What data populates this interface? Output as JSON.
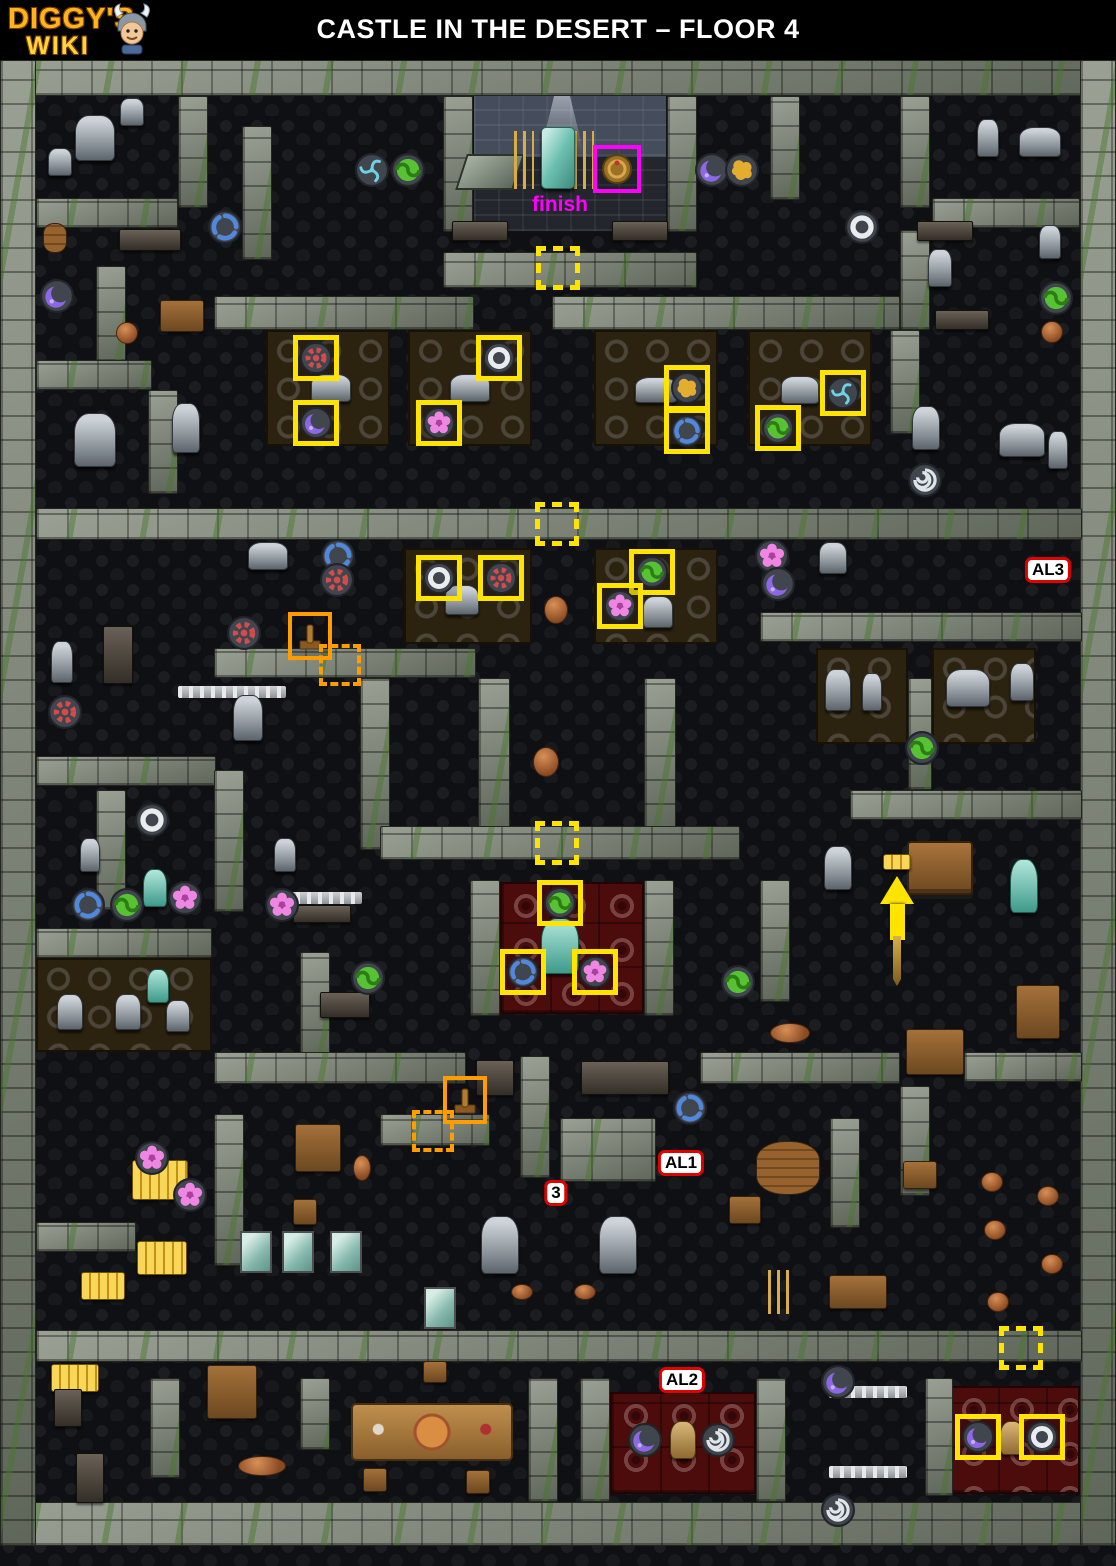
{
  "header": {
    "logo_line1": "DIGGY'S",
    "logo_line2": "WIKI",
    "title": "CASTLE IN THE DESERT – FLOOR 4"
  },
  "colors": {
    "highlight_yellow": "#ffe400",
    "highlight_orange": "#ff9d00",
    "finish_magenta": "#ff00ff",
    "label_border_red": "#e00000",
    "logo_orange": "#ffb41e",
    "wall_gray": "#7b8178",
    "moss_green": "#48762c",
    "carpet_red": "#4c0c0c",
    "floor_dark": "#0f1013"
  },
  "map": {
    "finish": {
      "label": "finish",
      "x": 560,
      "y": 205,
      "box_x": 617,
      "box_y": 169
    },
    "labels": [
      {
        "text": "AL3",
        "x": 1048,
        "y": 570
      },
      {
        "text": "AL1",
        "x": 681,
        "y": 1163
      },
      {
        "text": "3",
        "x": 556,
        "y": 1193
      },
      {
        "text": "AL2",
        "x": 682,
        "y": 1380
      }
    ],
    "yellow_boxes": [
      [
        "red-gear",
        316,
        358
      ],
      [
        "purple-crescent",
        316,
        423
      ],
      [
        "white-ring",
        499,
        358
      ],
      [
        "pink-flower",
        439,
        423
      ],
      [
        "gold-splat",
        687,
        388
      ],
      [
        "blue-swirl",
        687,
        431
      ],
      [
        "cyan-triskelion",
        843,
        393
      ],
      [
        "green-swirl",
        778,
        428
      ],
      [
        "white-ring",
        439,
        578
      ],
      [
        "red-gear",
        501,
        578
      ],
      [
        "green-swirl",
        652,
        572
      ],
      [
        "pink-flower",
        620,
        606
      ],
      [
        "green-swirl",
        560,
        903
      ],
      [
        "blue-swirl",
        523,
        972
      ],
      [
        "pink-flower",
        595,
        972
      ],
      [
        "purple-crescent",
        978,
        1437
      ],
      [
        "white-ring",
        1042,
        1437
      ]
    ],
    "hidden_passages": [
      [
        558,
        268
      ],
      [
        557,
        524
      ],
      [
        557,
        843
      ],
      [
        1021,
        1348
      ]
    ],
    "lever_boxes": [
      [
        310,
        636
      ],
      [
        465,
        1100
      ]
    ],
    "lever_targets": [
      [
        340,
        665
      ],
      [
        433,
        1131
      ]
    ],
    "arrow": {
      "x": 897,
      "y": 876
    },
    "loose_symbols": [
      [
        "cyan-triskelion",
        372,
        170
      ],
      [
        "green-swirl",
        408,
        170
      ],
      [
        "purple-crescent",
        712,
        170
      ],
      [
        "gold-splat",
        742,
        170
      ],
      [
        "blue-swirl",
        225,
        227
      ],
      [
        "white-ring",
        862,
        227
      ],
      [
        "purple-crescent",
        57,
        296
      ],
      [
        "green-swirl",
        1056,
        298
      ],
      [
        "white-spiral",
        925,
        480
      ],
      [
        "blue-swirl",
        338,
        556
      ],
      [
        "red-gear",
        337,
        580
      ],
      [
        "pink-flower",
        772,
        556
      ],
      [
        "purple-crescent",
        778,
        584
      ],
      [
        "red-gear",
        244,
        633
      ],
      [
        "red-gear",
        65,
        712
      ],
      [
        "green-swirl",
        922,
        748
      ],
      [
        "white-ring",
        152,
        820
      ],
      [
        "blue-swirl",
        88,
        905
      ],
      [
        "green-swirl",
        127,
        905
      ],
      [
        "pink-flower",
        185,
        898
      ],
      [
        "pink-flower",
        282,
        905
      ],
      [
        "green-swirl",
        368,
        978
      ],
      [
        "green-swirl",
        738,
        982
      ],
      [
        "blue-swirl",
        690,
        1108
      ],
      [
        "pink-flower",
        152,
        1158
      ],
      [
        "pink-flower",
        190,
        1195
      ],
      [
        "purple-crescent",
        838,
        1382
      ],
      [
        "white-spiral",
        838,
        1510
      ],
      [
        "purple-crescent",
        645,
        1440
      ],
      [
        "white-spiral",
        718,
        1440
      ]
    ],
    "items": [
      [
        "statue",
        "monkey-statue",
        95,
        138,
        40,
        46
      ],
      [
        "statue",
        "star-statue",
        60,
        162,
        24,
        28
      ],
      [
        "statue",
        "idol-statue",
        132,
        112,
        24,
        28
      ],
      [
        "statue",
        "lamb-statue",
        1040,
        142,
        42,
        30
      ],
      [
        "statue",
        "ferret-statue",
        988,
        138,
        22,
        38
      ],
      [
        "statue",
        "cat-statue",
        1050,
        242,
        22,
        34
      ],
      [
        "rack",
        "torture-rack",
        150,
        240,
        62,
        22
      ],
      [
        "barrel",
        "barrel",
        55,
        238,
        24,
        30
      ],
      [
        "rack",
        "weapon-rack",
        480,
        231,
        56,
        20
      ],
      [
        "rack",
        "weapon-rack-2",
        640,
        231,
        56,
        20
      ],
      [
        "rack",
        "torture-rack-2",
        945,
        231,
        56,
        20
      ],
      [
        "statue",
        "hanging-skeleton",
        940,
        268,
        24,
        38
      ],
      [
        "rack",
        "bone-pile",
        962,
        320,
        54,
        20
      ],
      [
        "wood",
        "cabinet",
        182,
        316,
        44,
        32
      ],
      [
        "pot",
        "stool",
        127,
        333,
        22,
        22
      ],
      [
        "pot",
        "stool-2",
        1052,
        332,
        22,
        22
      ],
      [
        "statue",
        "gargoyle-bust",
        95,
        440,
        42,
        54
      ],
      [
        "statue",
        "anubis-statue",
        186,
        428,
        28,
        50
      ],
      [
        "statue",
        "pharaoh-bust",
        926,
        428,
        28,
        44
      ],
      [
        "statue",
        "camel-figure",
        1022,
        440,
        46,
        34
      ],
      [
        "statue",
        "mummy-figure",
        1058,
        450,
        20,
        38
      ],
      [
        "statue",
        "frog-statue",
        331,
        388,
        40,
        28
      ],
      [
        "statue",
        "rat-statue",
        470,
        388,
        40,
        28
      ],
      [
        "statue",
        "turtle-statue",
        656,
        390,
        42,
        26
      ],
      [
        "statue",
        "squirrel-statue",
        800,
        390,
        38,
        28
      ],
      [
        "statue",
        "armor-piece",
        462,
        600,
        34,
        30
      ],
      [
        "statue",
        "dragon-statue",
        658,
        612,
        30,
        32
      ],
      [
        "pot",
        "brazier",
        556,
        610,
        24,
        28
      ],
      [
        "statue",
        "horse-statue",
        268,
        556,
        40,
        28
      ],
      [
        "statue",
        "bird-statue",
        833,
        558,
        28,
        32
      ],
      [
        "statue",
        "hermes-statue",
        62,
        662,
        22,
        42
      ],
      [
        "rack",
        "spear-rack",
        118,
        655,
        30,
        58
      ],
      [
        "railing",
        "ladder-rail",
        232,
        692,
        108,
        12
      ],
      [
        "statue",
        "knight-statue",
        248,
        718,
        30,
        46
      ],
      [
        "statue",
        "ibis-statue",
        838,
        690,
        26,
        42
      ],
      [
        "statue",
        "snake-statue",
        872,
        692,
        20,
        38
      ],
      [
        "statue",
        "camel-statue",
        968,
        688,
        44,
        38
      ],
      [
        "statue",
        "sphinx-bust",
        1022,
        682,
        24,
        38
      ],
      [
        "pot",
        "brazier-2",
        546,
        762,
        26,
        30
      ],
      [
        "teal",
        "ostrich-statue",
        560,
        946,
        38,
        56
      ],
      [
        "railing",
        "fence",
        318,
        898,
        88,
        12
      ],
      [
        "statue",
        "mask-figure",
        285,
        855,
        22,
        34
      ],
      [
        "statue",
        "robed-figure",
        90,
        855,
        20,
        34
      ],
      [
        "teal",
        "heron-statue",
        155,
        888,
        24,
        38
      ],
      [
        "rack",
        "spear-row",
        322,
        914,
        58,
        18
      ],
      [
        "statue",
        "tiki-idol",
        70,
        1012,
        26,
        36
      ],
      [
        "statue",
        "tiki-idol-2",
        128,
        1012,
        26,
        36
      ],
      [
        "teal",
        "teal-bird",
        158,
        986,
        22,
        34
      ],
      [
        "statue",
        "tiki-idol-3",
        178,
        1016,
        24,
        32
      ],
      [
        "rack",
        "bone-rack",
        345,
        1005,
        50,
        26
      ],
      [
        "statue",
        "armor-stand",
        838,
        868,
        28,
        44
      ],
      [
        "cart",
        "barrel-cart",
        940,
        868,
        66,
        54
      ],
      [
        "gold",
        "golden-lever",
        897,
        862,
        28,
        16
      ],
      [
        "teal",
        "mummy-case",
        1024,
        886,
        28,
        54
      ],
      [
        "wood",
        "crate-cart",
        935,
        1052,
        58,
        46
      ],
      [
        "wood",
        "cage",
        1038,
        1012,
        44,
        54
      ],
      [
        "pot",
        "fruit-stand",
        790,
        1033,
        40,
        20
      ],
      [
        "rack",
        "halberd-rack",
        495,
        1078,
        38,
        36
      ],
      [
        "rack",
        "skeleton-table",
        625,
        1078,
        88,
        34
      ],
      [
        "wood",
        "shelf-unit",
        318,
        1148,
        46,
        48
      ],
      [
        "pot",
        "amphora",
        362,
        1168,
        18,
        26
      ],
      [
        "wood",
        "chair",
        305,
        1212,
        24,
        26
      ],
      [
        "gold",
        "gold-stack",
        160,
        1180,
        56,
        40
      ],
      [
        "gold",
        "gold-stack-2",
        162,
        1258,
        50,
        34
      ],
      [
        "gold",
        "gold-stack-3",
        103,
        1286,
        44,
        28
      ],
      [
        "gold",
        "gold-bars",
        75,
        1378,
        48,
        28
      ],
      [
        "glass",
        "glass-pane",
        256,
        1252,
        32,
        42
      ],
      [
        "glass",
        "glass-pane-2",
        298,
        1252,
        32,
        42
      ],
      [
        "glass",
        "glass-pane-3",
        346,
        1252,
        32,
        42
      ],
      [
        "glass",
        "glass-pane-4",
        440,
        1308,
        32,
        42
      ],
      [
        "statue",
        "ghost-statue",
        500,
        1245,
        38,
        58
      ],
      [
        "statue",
        "ghost-statue-2",
        618,
        1245,
        38,
        58
      ],
      [
        "pot",
        "bowl",
        522,
        1292,
        22,
        16
      ],
      [
        "pot",
        "bowl-2",
        585,
        1292,
        22,
        16
      ],
      [
        "barrel",
        "barrel-stack",
        788,
        1168,
        64,
        54
      ],
      [
        "wood",
        "crate",
        745,
        1210,
        32,
        28
      ],
      [
        "wood",
        "side-table",
        920,
        1175,
        34,
        28
      ],
      [
        "pot",
        "stool-3",
        992,
        1182,
        22,
        20
      ],
      [
        "pot",
        "stool-4",
        1048,
        1196,
        22,
        20
      ],
      [
        "pot",
        "stool-5",
        995,
        1230,
        22,
        20
      ],
      [
        "pot",
        "stool-6",
        1052,
        1264,
        22,
        20
      ],
      [
        "pot",
        "stool-7",
        998,
        1302,
        22,
        20
      ],
      [
        "candle",
        "candelabra-3",
        780,
        1292,
        24,
        44
      ],
      [
        "wood",
        "crates",
        858,
        1292,
        58,
        34
      ],
      [
        "rack",
        "weapon-pile",
        68,
        1408,
        28,
        38
      ],
      [
        "rack",
        "bow-rack",
        90,
        1478,
        28,
        50
      ],
      [
        "wood",
        "cupboard",
        232,
        1392,
        50,
        54
      ],
      [
        "pot",
        "pottery",
        262,
        1466,
        48,
        20
      ],
      [
        "wood",
        "chair-2",
        435,
        1372,
        24,
        22
      ],
      [
        "table",
        "banquet-table",
        432,
        1432,
        162,
        58
      ],
      [
        "wood",
        "chair-3",
        375,
        1480,
        24,
        24
      ],
      [
        "wood",
        "chair-4",
        478,
        1482,
        24,
        24
      ],
      [
        "railing",
        "balustrade",
        868,
        1392,
        78,
        12
      ],
      [
        "railing",
        "balustrade-2",
        868,
        1472,
        78,
        12
      ],
      [
        "idol",
        "gold-idol",
        683,
        1440,
        26,
        38
      ],
      [
        "idol",
        "gold-idol-2",
        1012,
        1438,
        24,
        34
      ],
      [
        "slab",
        "stone-slab",
        490,
        172,
        58,
        36
      ],
      [
        "candle",
        "candelabra",
        524,
        160,
        20,
        58
      ],
      [
        "candle",
        "candelabra-2",
        584,
        160,
        20,
        58
      ],
      [
        "obelisk",
        "obelisk",
        558,
        158,
        34,
        62
      ]
    ]
  }
}
